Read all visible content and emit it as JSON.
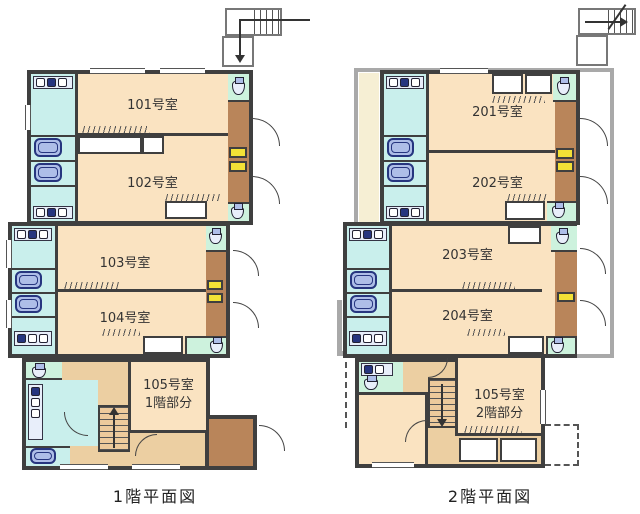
{
  "palette": {
    "wall": "#3f3f3f",
    "room": "#fae3c1",
    "wet": "#c9efec",
    "wc": "#cdf2dd",
    "fixture": "#aebee8",
    "fixdark": "#26357f",
    "deck": "#b9855a",
    "hall": "#eccfa2",
    "stair": "#edca9c",
    "accent": "#f2e136",
    "corridor": "#f6efd4",
    "gray": "#a9a9a9",
    "text": "#333333"
  },
  "floor1": {
    "caption": "1階平面図",
    "rooms": [
      {
        "label": "101号室"
      },
      {
        "label": "102号室"
      },
      {
        "label": "103号室"
      },
      {
        "label": "104号室"
      },
      {
        "label": "105号室",
        "sublabel": "1階部分"
      }
    ]
  },
  "floor2": {
    "caption": "2階平面図",
    "rooms": [
      {
        "label": "201号室"
      },
      {
        "label": "202号室"
      },
      {
        "label": "203号室"
      },
      {
        "label": "204号室"
      },
      {
        "label": "105号室",
        "sublabel": "2階部分"
      }
    ]
  }
}
